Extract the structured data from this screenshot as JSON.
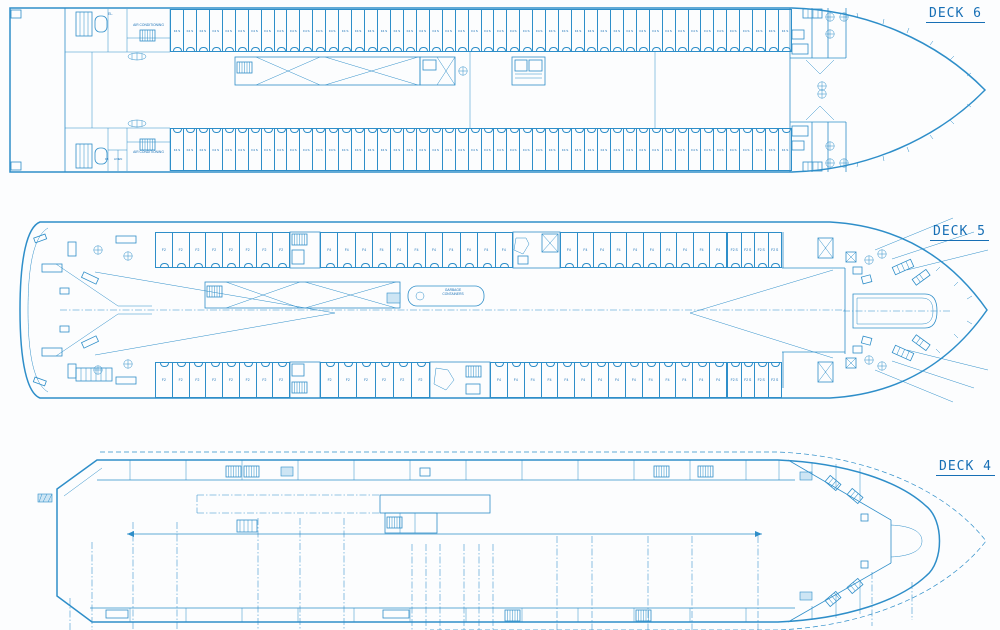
{
  "palette": {
    "ink": "#2e8ec9",
    "ink_dark": "#176fb5",
    "paper": "#fcfdfe",
    "fill_light": "#cde5f4"
  },
  "decks": [
    {
      "id": "deck-6",
      "label": "DECK 6",
      "rooms": {
        "air_conditioning_top": "AIR CONDITIONING",
        "air_conditioning_bottom": "AIR CONDITIONING",
        "elevator": "EL.",
        "f5": "F5",
        "linen": "LINEN"
      },
      "cabin_rows": [
        {
          "side": "top",
          "label": "F4 S",
          "count": 48
        },
        {
          "side": "bottom",
          "label": "F4 S",
          "count": 48
        }
      ]
    },
    {
      "id": "deck-5",
      "label": "DECK 5",
      "rooms": {
        "garbage_line1": "GARBAGE",
        "garbage_line2": "CONTAINERS"
      },
      "cabin_rows": [
        {
          "side": "top-aft",
          "label": "F2",
          "count": 8
        },
        {
          "side": "top-mid-1",
          "label": "F4",
          "count": 11
        },
        {
          "side": "top-mid-2",
          "label": "F4",
          "count": 10
        },
        {
          "side": "top-forward",
          "label": "F2 S",
          "count": 4
        },
        {
          "side": "bottom-aft",
          "label": "F2",
          "count": 8
        },
        {
          "side": "bottom-mid-1",
          "label": "F2",
          "count": 6
        },
        {
          "side": "bottom-mid-2",
          "label": "F4",
          "count": 14
        },
        {
          "side": "bottom-forward",
          "label": "F2 S",
          "count": 4
        }
      ]
    },
    {
      "id": "deck-4",
      "label": "DECK 4",
      "rooms": {},
      "cabin_rows": []
    }
  ]
}
